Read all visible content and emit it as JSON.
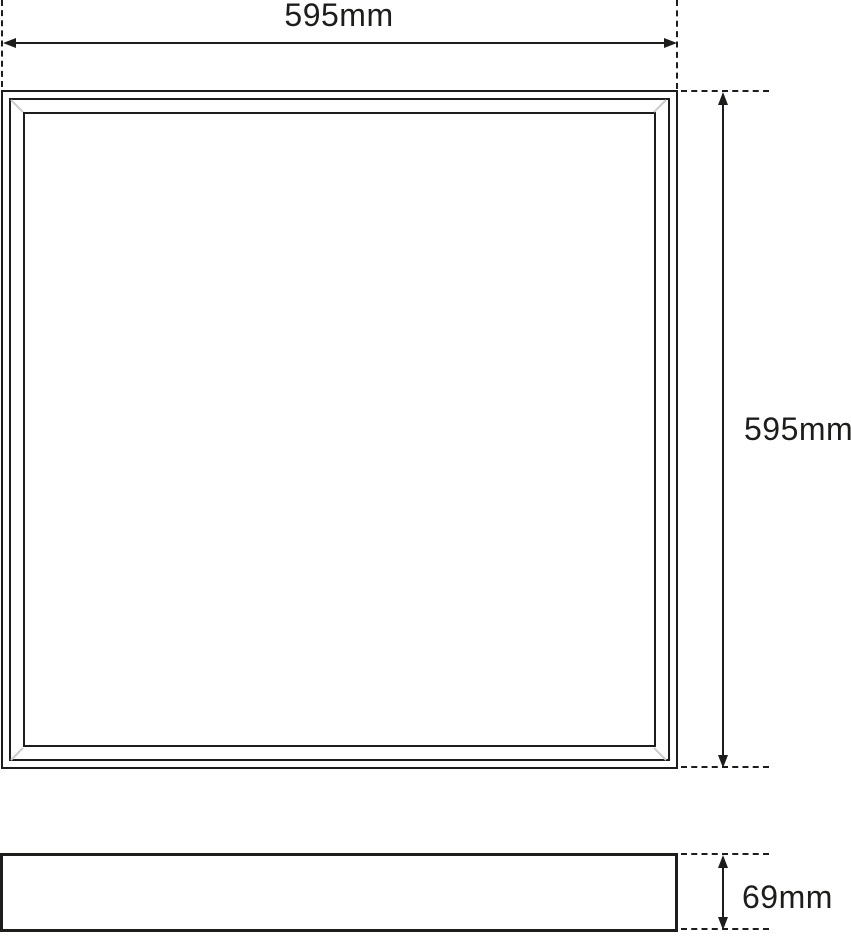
{
  "page": {
    "background_color": "#ffffff"
  },
  "drawing": {
    "type": "technical-dimension-drawing",
    "line_color": "#1d1d1b",
    "corner_mitre_color": "#cccccc",
    "views": {
      "front_view": "square panel with triple frame",
      "side_view": "thin profile bar"
    },
    "dimensions": {
      "width": {
        "label": "595mm",
        "orientation": "horizontal",
        "applies_to": "front_view"
      },
      "height": {
        "label": "595mm",
        "orientation": "vertical",
        "applies_to": "front_view"
      },
      "depth": {
        "label": "69mm",
        "orientation": "vertical",
        "applies_to": "side_view"
      }
    }
  }
}
